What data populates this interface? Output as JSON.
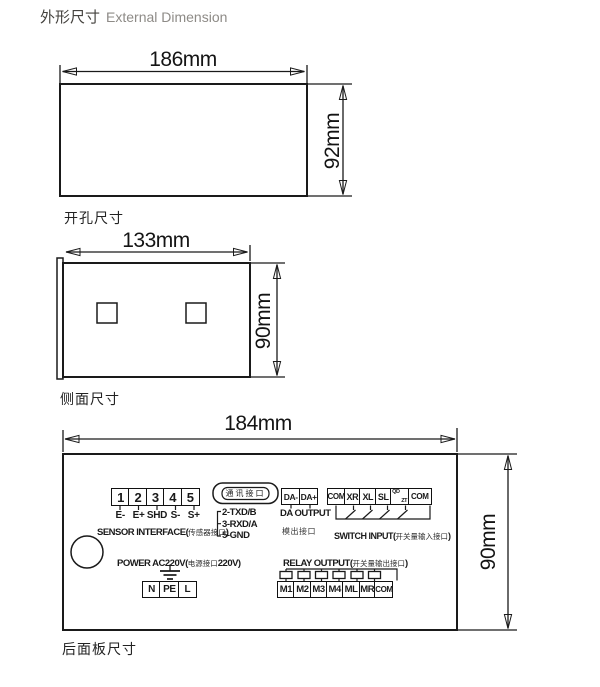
{
  "title": {
    "zh": "外形尺寸",
    "en": "External Dimension"
  },
  "colors": {
    "line": "#1a1a1a",
    "text": "#1a1a1a",
    "muted_text": "#8e8b87"
  },
  "figures": {
    "front_view": {
      "width": "186mm",
      "height": "92mm",
      "caption": "开孔尺寸"
    },
    "side_view": {
      "width": "133mm",
      "height": "90mm",
      "caption": "侧面尺寸"
    },
    "back_panel": {
      "width": "184mm",
      "height": "90mm",
      "caption": "后面板尺寸",
      "sensor": {
        "terminals": [
          "1",
          "2",
          "3",
          "4",
          "5"
        ],
        "pins": [
          "E-",
          "E+",
          "SHD",
          "S-",
          "S+"
        ],
        "label_en": "SENSOR INTERFACE(",
        "label_zh": "传感器接口",
        "label_close": ")"
      },
      "comm": {
        "port": "通讯接口",
        "pins": [
          "2-TXD/B",
          "3-RXD/A",
          "5-GND"
        ]
      },
      "da": {
        "terminals": [
          "DA-",
          "DA+"
        ],
        "label_en": "DA OUTPUT",
        "label_zh": "模出接口"
      },
      "switch": {
        "terminals": [
          "COM",
          "XR",
          "XL",
          "SL",
          "QD/ZT",
          "COM"
        ],
        "split_top": "QD",
        "split_bottom": "ZT",
        "label_en": "SWITCH INPUT(",
        "label_zh": "开关量输入接口",
        "label_close": ")"
      },
      "power": {
        "label_en": "POWER AC220V(",
        "label_zh": "电源接口",
        "label_tail": "220V)",
        "terminals": [
          "N",
          "PE",
          "L"
        ]
      },
      "relay": {
        "label_en": "RELAY OUTPUT(",
        "label_zh": "开关量输出接口",
        "label_close": ")",
        "terminals": [
          "M1",
          "M2",
          "M3",
          "M4",
          "ML",
          "MR",
          "COM"
        ]
      }
    }
  }
}
